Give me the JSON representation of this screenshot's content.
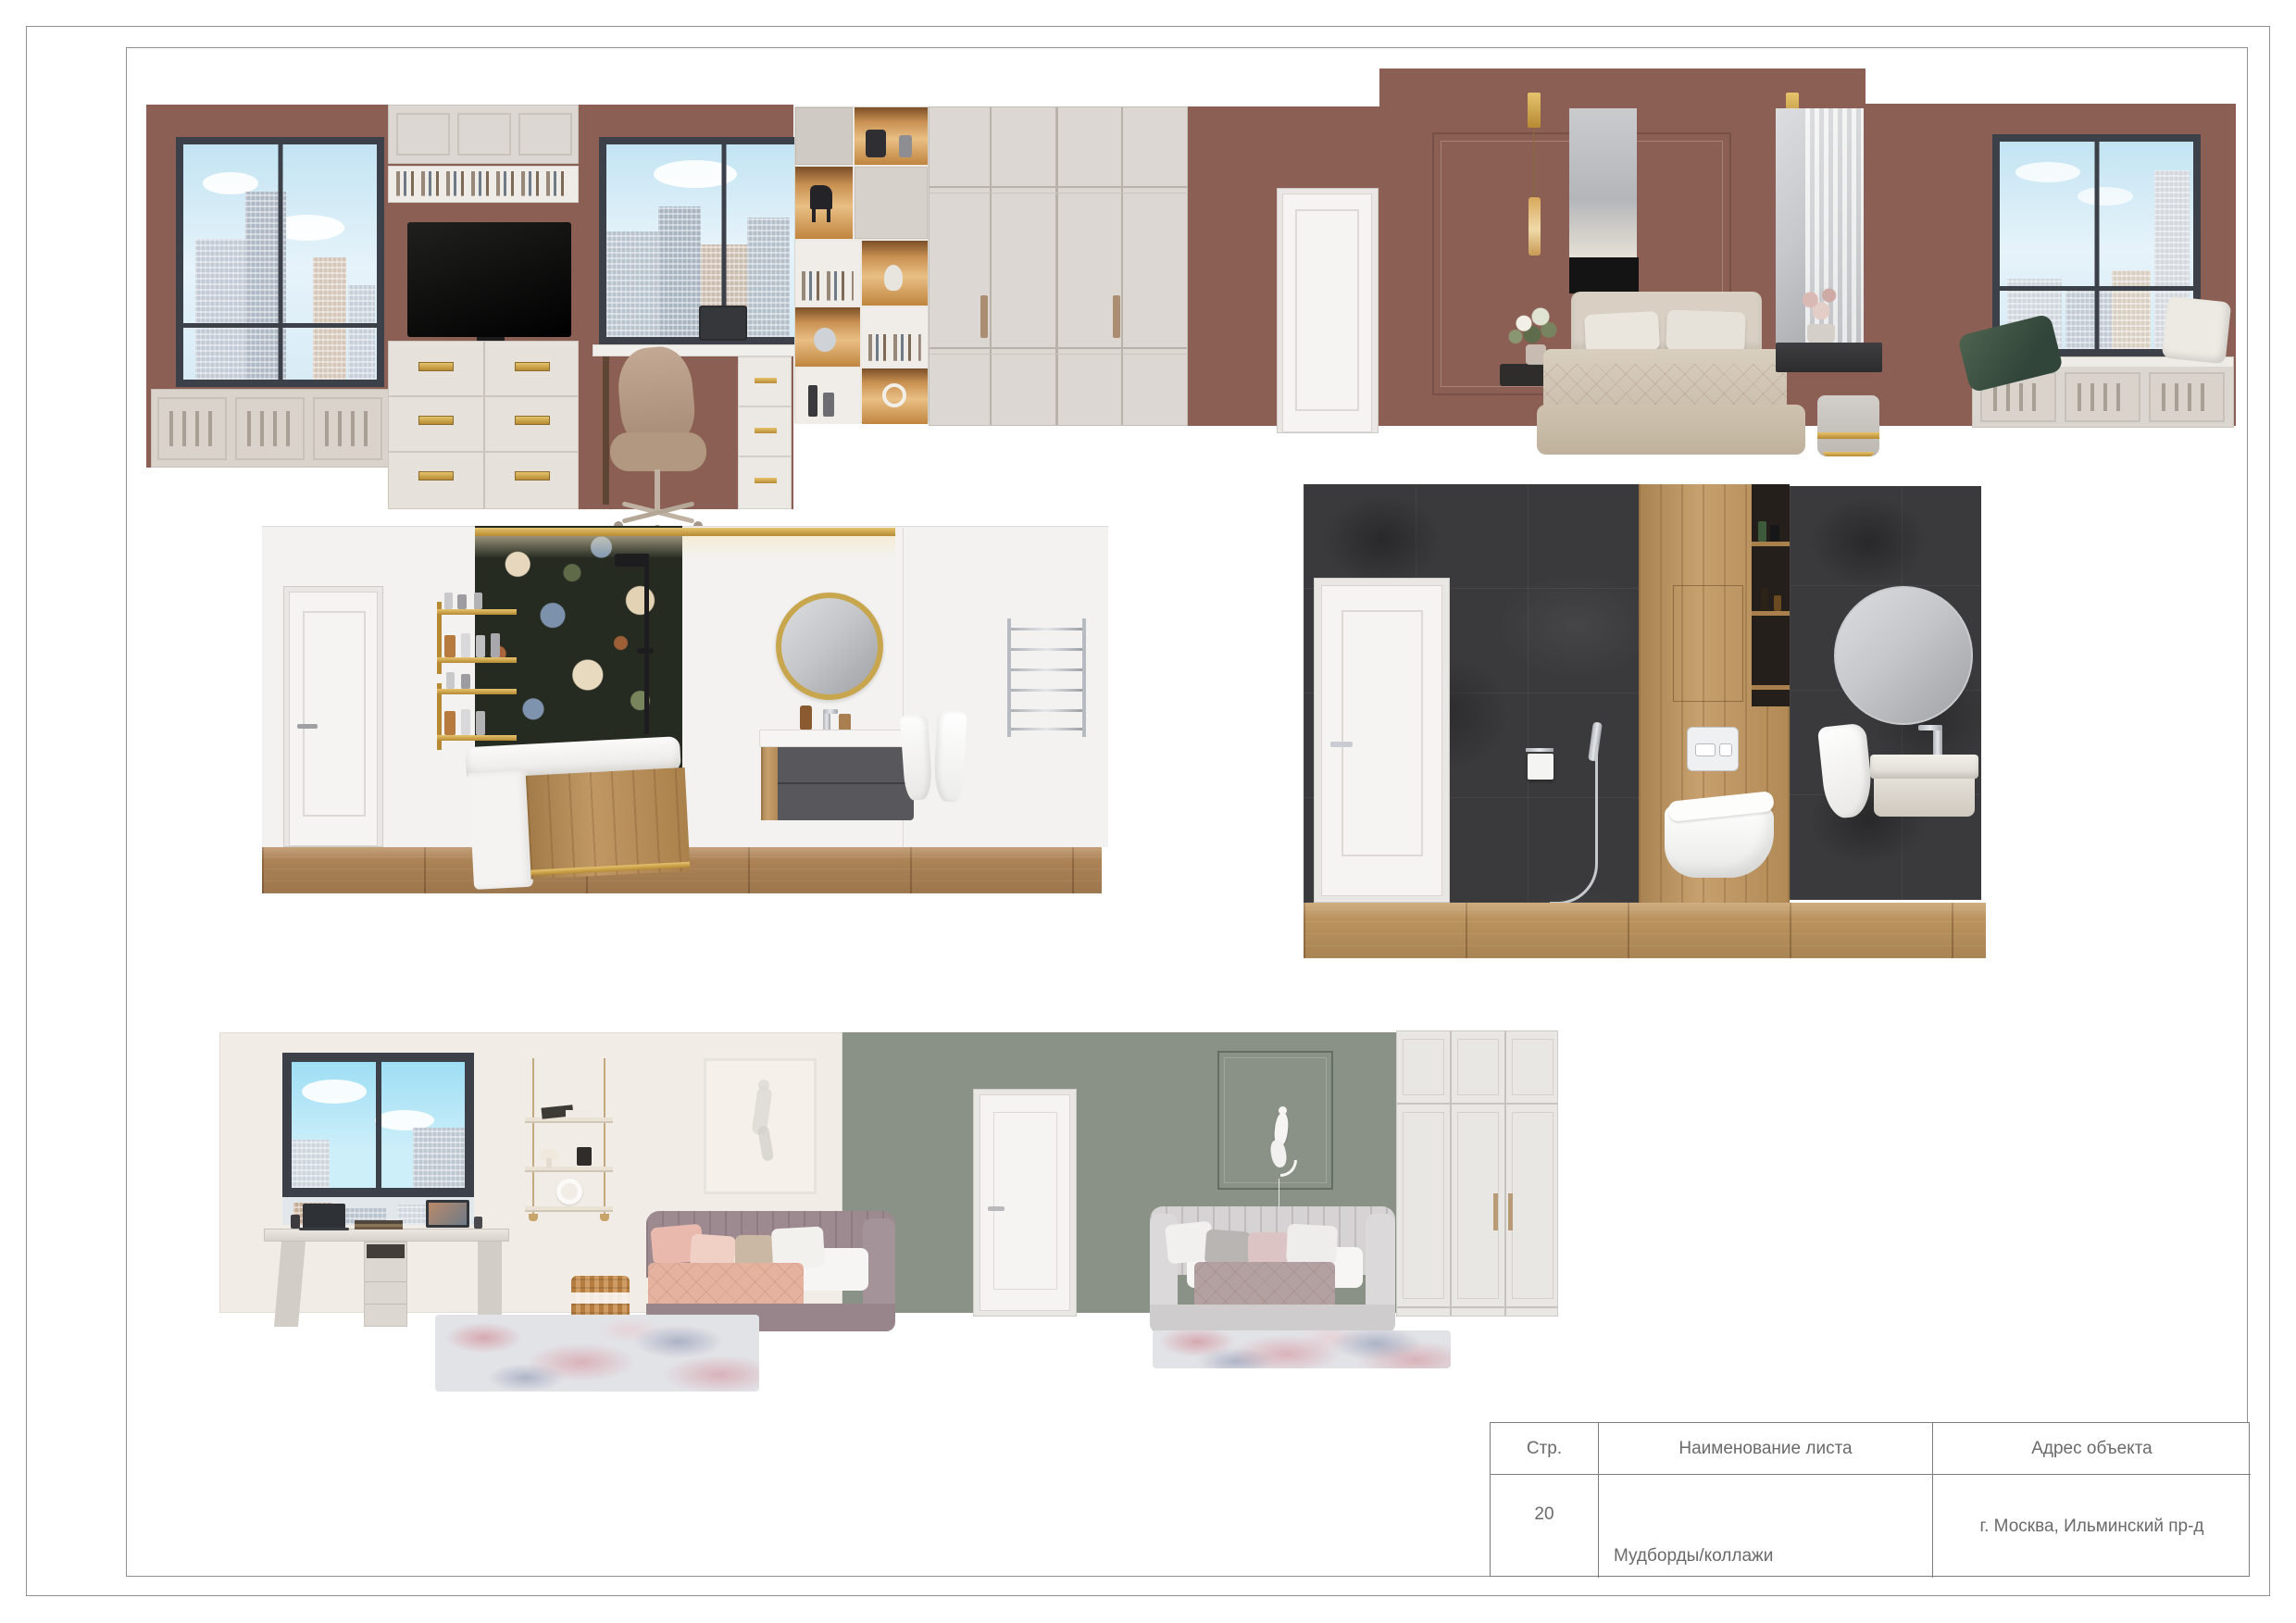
{
  "sheet": {
    "title_block": {
      "headers": {
        "page": "Стр.",
        "sheet_name": "Наименование листа",
        "address": "Адрес объекта"
      },
      "row": {
        "page": "20",
        "sheet_name": "Мудборды/коллажи",
        "address": "г. Москва, Ильминский пр-д"
      }
    },
    "boards": {
      "bedroom": "bedroom-elevation-moodboard",
      "bathroom_light": "bathroom-moodboard-light-floral",
      "bathroom_dark": "bathroom-moodboard-dark-tile",
      "kids_room": "kids-room-moodboard"
    },
    "colors": {
      "bedroom_wall": "#8b5f54",
      "cabinetry": "#dcd7d2",
      "window_frame": "#3b4049",
      "gold_accent": "#c9a242",
      "green_pillow": "#3f5244",
      "bath_light_wall": "#f3f2f0",
      "floral_wallpaper_base": "#262b22",
      "wood_floor": "#b5895a",
      "bath_dark_tile": "#3a3a3c",
      "bath_wood": "#c0955d",
      "kids_cream_wall": "#f2ece6",
      "kids_green_wall": "#8a9287",
      "plum_sofa": "#9c8a90",
      "gray_sofa": "#d5d2d3",
      "border_line": "#8f8f8f"
    }
  }
}
